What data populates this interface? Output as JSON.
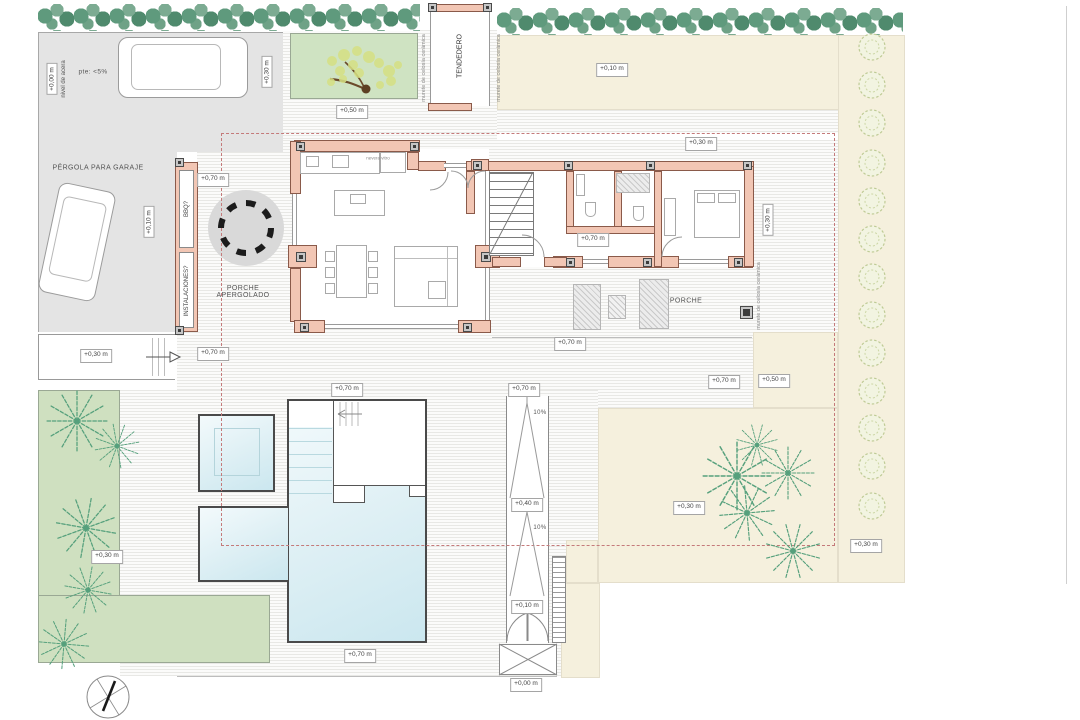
{
  "areas": {
    "pergola_garaje": "PÉRGOLA PARA GARAJE",
    "porche_apergolado_line1": "PORCHE",
    "porche_apergolado_line2": "APERGOLADO",
    "porche": "PORCHE",
    "tendedero": "TENDEDERO",
    "bbq": "BBQ?",
    "instalaciones": "INSTALACIONES?"
  },
  "annotations": {
    "nivel_acera": "nivel de acera",
    "pendiente_garaje": "pte: <5%",
    "murete": "murete de celosía cerámica",
    "kitchen_note": "nevera vitro",
    "slope_upper": "10%",
    "slope_lower": "10%"
  },
  "elevations": {
    "acera": "+0,00 m",
    "garage_top": "+0,30 m",
    "garage_interior": "+0,10 m",
    "garden_patch": "+0,50 m",
    "north_lawn": "+0,10 m",
    "north_house": "+0,30 m",
    "walkway": "+0,30 m",
    "pergola_top": "+0,70 m",
    "pergola_bottom": "+0,70 m",
    "hall": "+0,70 m",
    "bedroom_side": "+0,30 m",
    "porch_west": "+0,70 m",
    "porch_south": "+0,70 m",
    "porch_southeast": "+0,50 m",
    "pool_deck_top": "+0,70 m",
    "ramp_top": "+0,70 m",
    "ramp_mid": "+0,40 m",
    "ramp_low": "+0,10 m",
    "gate": "+0,00 m",
    "pool_deck_bottom": "+0,70 m",
    "garden_left": "+0,30 m",
    "garden_southeast": "+0,30 m",
    "garden_east": "+0,30 m"
  },
  "colors": {
    "wall_fill": "#f2c6b4",
    "wall_outline": "#8a5a4a",
    "garage_gray": "#e4e4e4",
    "lawn_beige": "#f5f0dd",
    "garden_green": "#cfe0c0",
    "pool_blue": "#cbe7ef",
    "hedge_green": "#5f9a7d",
    "setback_red": "#c47a7a"
  }
}
